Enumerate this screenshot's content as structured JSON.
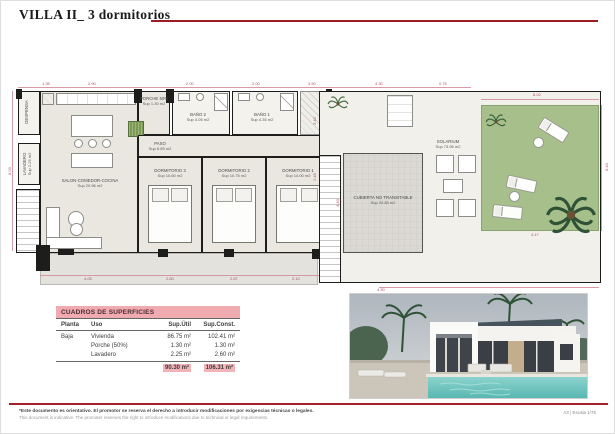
{
  "title": "VILLA II_ 3 dormitorios",
  "groundplan": {
    "rooms": {
      "salon": {
        "name": "SALON-COMEDOR-COCINA",
        "area": "Sup 20.96 m2"
      },
      "porche": {
        "name": "PORCHE 50%",
        "area": "Sup 1.30 m2"
      },
      "bano2": {
        "name": "BAÑO 2",
        "area": "Sup 4.05 m2"
      },
      "bano1": {
        "name": "BAÑO 1",
        "area": "Sup 4.35 m2"
      },
      "paso": {
        "name": "PASO",
        "area": "Sup 6.65 m2"
      },
      "dorm3": {
        "name": "DORMITORIO 3",
        "area": "Sup 10.60 m2"
      },
      "dorm2": {
        "name": "DORMITORIO 2",
        "area": "Sup 10.75 m2"
      },
      "dorm1": {
        "name": "DORMITORIO 1",
        "area": "Sup 14.00 m2"
      },
      "lavadero": {
        "name": "LAVADERO",
        "area": "Sup 2.25 m2"
      },
      "despensa": {
        "name": "DESPENSA",
        "area": ""
      }
    },
    "dims": {
      "top1": "1.35",
      "top2": "2.90",
      "top3": "2.00",
      "top4": "2.00",
      "top5": "3.50",
      "left1": "8.03",
      "right1": "4.40",
      "bottom1": "4.05",
      "bottom2": "2.80",
      "bottom3": "2.87",
      "bottom4": "2.10"
    }
  },
  "roofplan": {
    "solarium": {
      "name": "SOLARIUM",
      "area": "Sup 73.95 m2"
    },
    "cubierta": {
      "name": "CUBIERTA NO TRANSITABLE",
      "area": "Sup 20.85 m2"
    },
    "dims": {
      "top1": "4.30",
      "top2": "0.75",
      "top3": "8.02",
      "left1": "3.40",
      "left2": "2.45",
      "right1": "8.40",
      "bottom1": "4.30",
      "bottom2": "4.17"
    }
  },
  "table": {
    "title": "CUADROS DE SUPERFICIES",
    "columns": {
      "c1": "Planta",
      "c2": "Uso",
      "c3": "Sup.Útil",
      "c4": "Sup.Const."
    },
    "rows": [
      {
        "planta": "Baja",
        "uso": "Vivienda",
        "util": "86.75 m²",
        "const": "102.41 m²"
      },
      {
        "planta": "",
        "uso": "Porche (50%)",
        "util": "1.30 m²",
        "const": "1.30 m²"
      },
      {
        "planta": "",
        "uso": "Lavadero",
        "util": "2.25 m²",
        "const": "2.60 m²"
      }
    ],
    "total": {
      "util": "90.30 m²",
      "const": "106.31 m²"
    }
  },
  "footer": {
    "disclaimer_es": "*Este documento es orientativo. El promotor se reserva el derecho a introducir modificaciones por exigencias técnicas o legales.",
    "disclaimer_en": "This document is indicative. The promoter reserves the right to introduce modifications due to technical or legal requirements.",
    "sheet": "A3 | Escala 1/75"
  },
  "colors": {
    "accent_red": "#9e1b28",
    "table_pink": "#f0abb0",
    "plan_floor": "#eae7e0",
    "wall_black": "#1d1d1b",
    "lawn_green": "#a7bf8b",
    "dim_pink": "#d2909a",
    "pool_teal": "#6fc7c1"
  }
}
